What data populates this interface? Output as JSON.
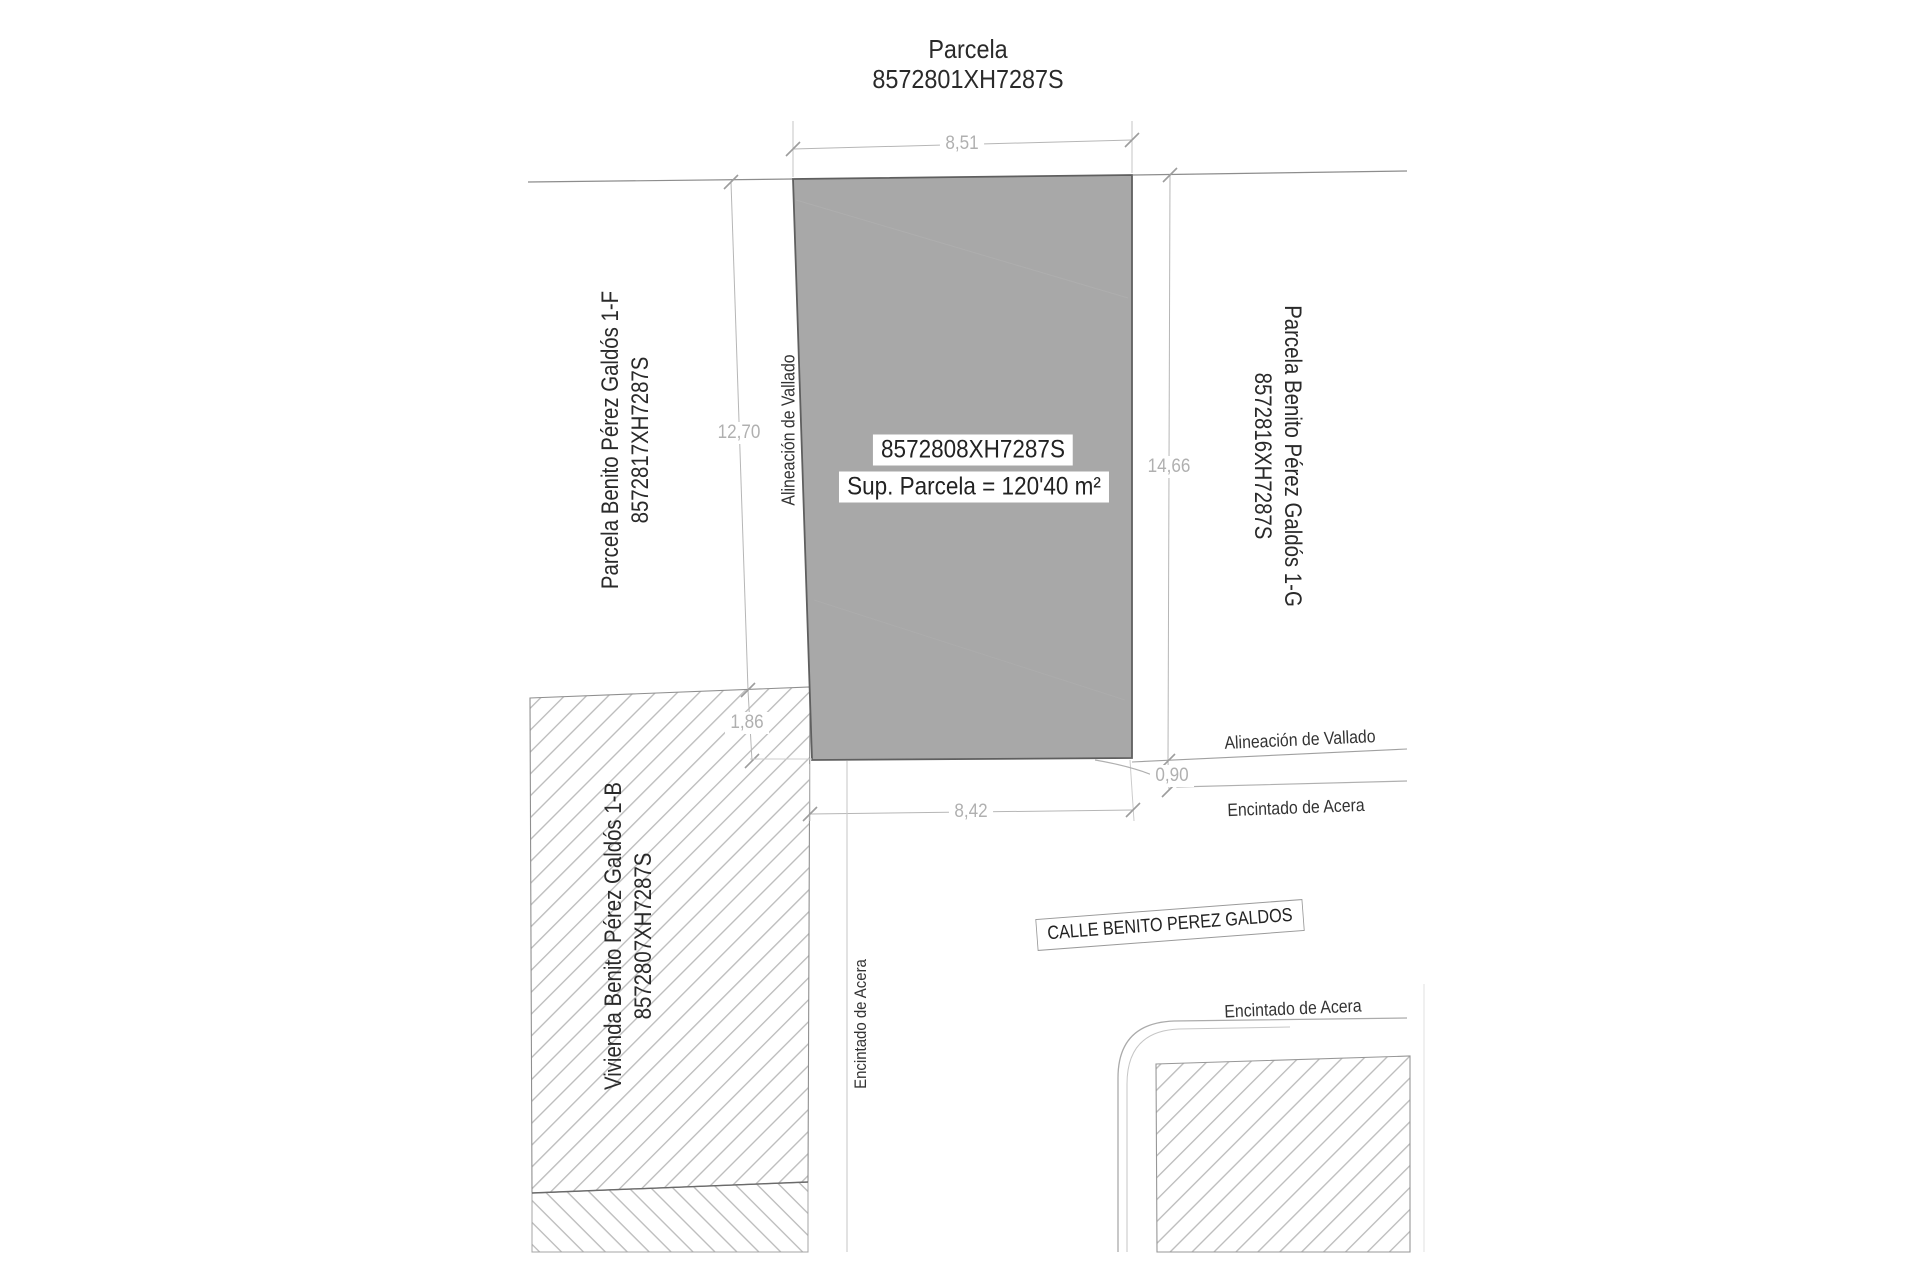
{
  "title": {
    "line1": "Parcela",
    "line2": "8572801XH7287S"
  },
  "parcel": {
    "ref_label": "8572808XH7287S",
    "area_label": "Sup. Parcela = 120'40 m²"
  },
  "neighbors": {
    "left": {
      "line1": "Parcela Benito Pérez Galdós 1-F",
      "line2": "8572817XH7287S"
    },
    "right": {
      "line1": "Parcela Benito Pérez Galdós 1-G",
      "line2": "8572816XH7287S"
    },
    "bottom_left": {
      "line1": "Vivienda Benito Pérez Galdós 1-B",
      "line2": "8572807XH7287S"
    }
  },
  "street": {
    "name": "CALLE BENITO PEREZ GALDOS"
  },
  "annotations": {
    "vallado_left": "Alineación de Vallado",
    "vallado_right": "Alineación de Vallado",
    "acera_right_upper": "Encintado de Acera",
    "acera_left_vertical": "Encintado de Acera",
    "acera_bottom_right": "Encintado de Acera"
  },
  "dimensions": {
    "top_width": "8,51",
    "left_height": "12,70",
    "right_height": "14,66",
    "left_gap": "1,86",
    "bottom_width": "8,42",
    "curb_offset": "0,90"
  },
  "colors": {
    "parcel_fill": "#a8a8a8",
    "parcel_border": "#5f5f5f",
    "boundary_line": "#8d8d8d",
    "dimension_line": "#b6b6b6",
    "dim_text": "#b0b0b0",
    "hatch_line": "#b9b9b9",
    "text": "#2a2a2a"
  }
}
